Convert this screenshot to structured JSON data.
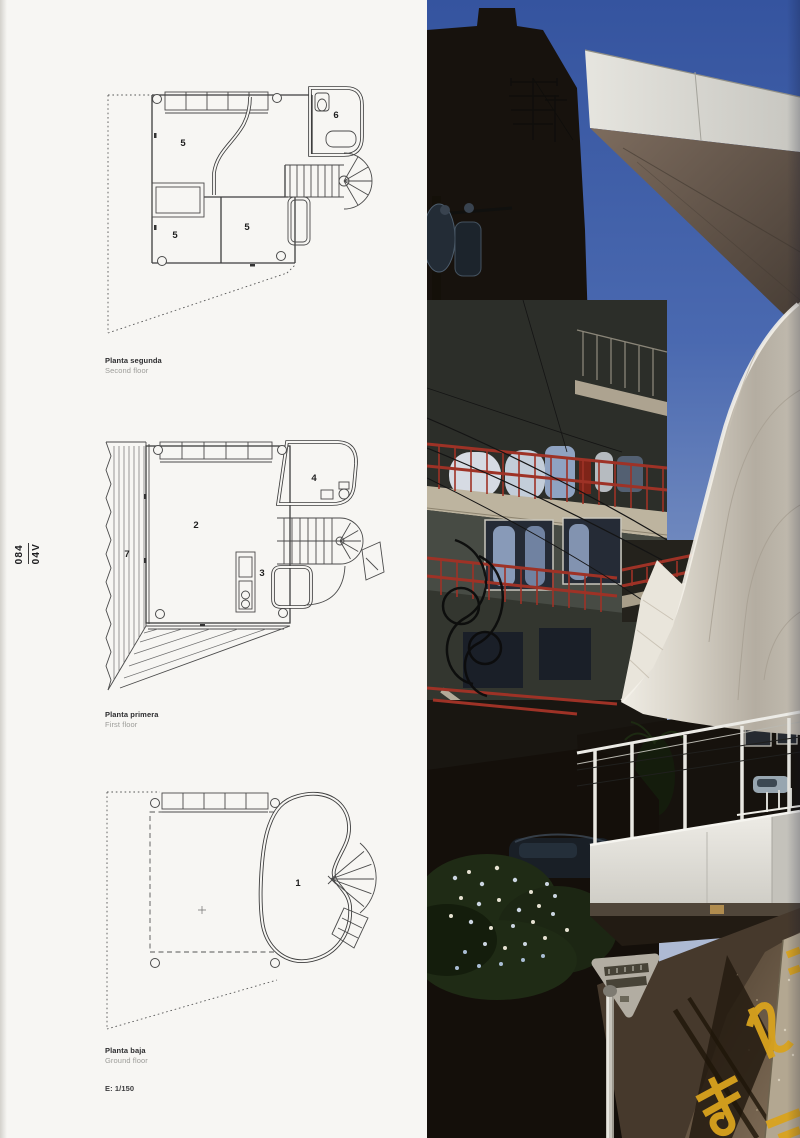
{
  "page": {
    "page_number": "084",
    "project_code": "04V"
  },
  "plans": {
    "second": {
      "caption_primary": "Planta segunda",
      "caption_secondary": "Second floor",
      "rooms": {
        "a": "5",
        "b": "6",
        "c": "5",
        "d": "5"
      }
    },
    "first": {
      "caption_primary": "Planta primera",
      "caption_secondary": "First floor",
      "rooms": {
        "living": "2",
        "kitchen": "3",
        "bath": "4",
        "deck": "7"
      }
    },
    "ground": {
      "caption_primary": "Planta baja",
      "caption_secondary": "Ground floor",
      "rooms": {
        "studio": "1"
      }
    }
  },
  "scale_note": "E: 1/150",
  "photo": {
    "road_marking": "止まれ"
  },
  "colors": {
    "railing_red": "#9e3226",
    "marking_yellow": "#d9a31e",
    "sky_top": "#35549f",
    "sky_light": "#a9b7d3",
    "membrane": "#d8d3c8",
    "paper": "#f7f6f3"
  }
}
